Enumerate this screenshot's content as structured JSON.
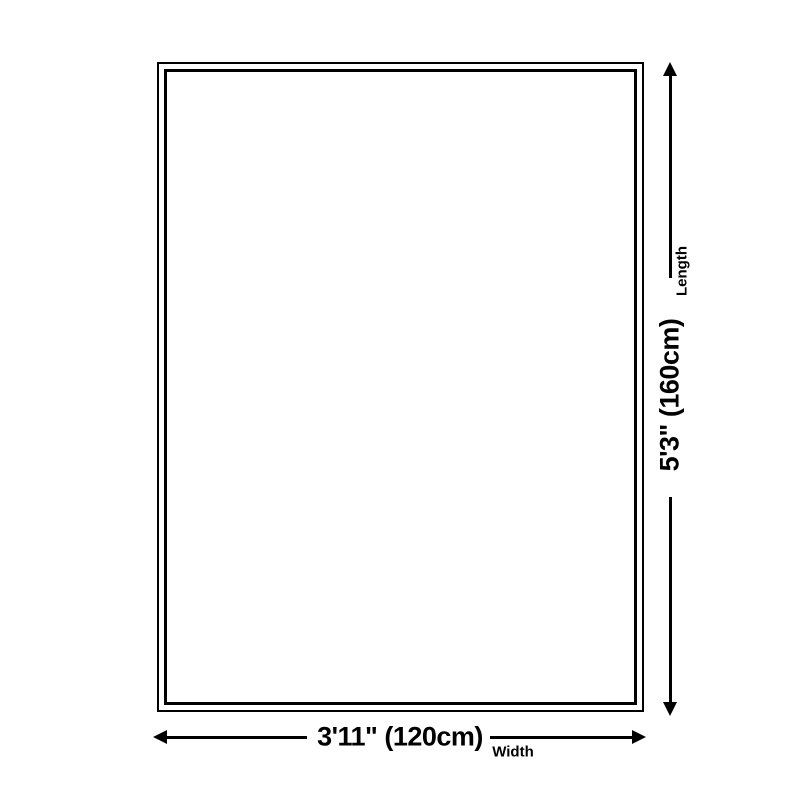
{
  "page": {
    "background": "#ffffff",
    "ink_color": "#000000"
  },
  "diagram": {
    "type": "product-size-diagram",
    "outline": {
      "shape": "rectangle",
      "border_style": "double"
    },
    "length": {
      "label": "Length",
      "value": "5'3\" (160cm)"
    },
    "width": {
      "label": "Width",
      "value": "3'11\" (120cm)"
    }
  }
}
